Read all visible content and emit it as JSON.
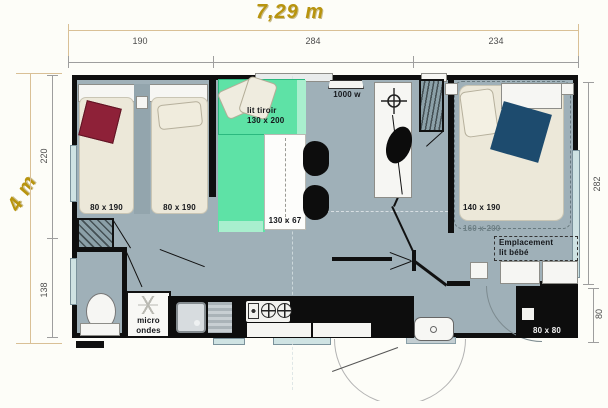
{
  "title": {
    "width": "7,29 m",
    "height": "4 m"
  },
  "dims": {
    "top": [
      "190",
      "284",
      "234"
    ],
    "left": [
      "220",
      "138"
    ],
    "right": [
      "282",
      "80"
    ]
  },
  "labels": {
    "bed_small_1": "80 x 190",
    "bed_small_2": "80 x 190",
    "sofa_line1": "lit tiroir",
    "sofa_line2": "130 x 200",
    "table": "130 x 67",
    "heater": "1000 w",
    "micro_line1": "micro",
    "micro_line2": "ondes",
    "bed_double": "140 x 190",
    "bed_double_outer": "160 x 200",
    "baby_line1": "Emplacement",
    "baby_line2": "lit bébé",
    "shower": "80 x 80"
  },
  "colors": {
    "floor": "#9fb0b8",
    "wall": "#0f0f0f",
    "sofa_green": "#5ee2a6",
    "sofa_green_light": "#a9efce",
    "accent_gold": "#b8940e",
    "bed_cream": "#ece8d9",
    "pillow_burgundy": "#8e2138",
    "blanket_navy": "#1d4b6e",
    "window_glass": "#cfe3e3",
    "dim_line_tan": "#d9c096"
  }
}
